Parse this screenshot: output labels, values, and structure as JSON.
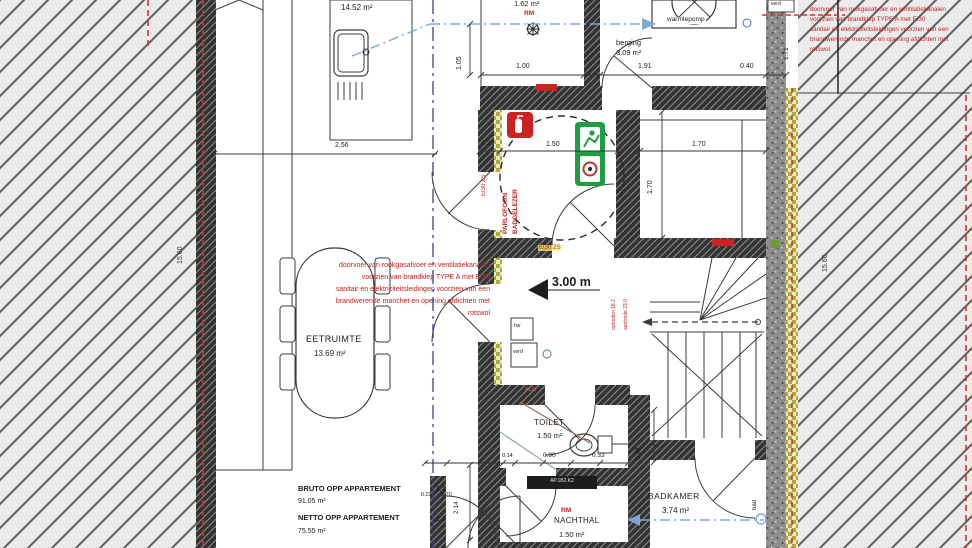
{
  "rooms": {
    "kitchen_area": "14.52 m²",
    "top_small_room_area": "1.62 m²",
    "berging_name": "berging",
    "berging_area": "3.09 m²",
    "eetruimte_name": "EETRUIMTE",
    "eetruimte_area": "13.69 m²",
    "toilet_name": "TOILET",
    "toilet_area": "1.50 m²",
    "nachthal_name": "NACHTHAL",
    "nachthal_area": "1.50 m²",
    "badkamer_name": "BADKAMER",
    "badkamer_area": "3.74 m²"
  },
  "labels": {
    "warmtepomp": "warmtepomp",
    "verd_top": "verd",
    "verd_hall": "verd",
    "hw": "hw",
    "alg": "ALG",
    "bad": "bad",
    "rm_top": "RM",
    "rm_nachthal": "RM",
    "ceiling_height": "3.00 m",
    "ei30_zs_wall": "EI30 ZS",
    "ei30_zs_vertical": "EI30 ZS",
    "intercom_line1": "PARLOFOON",
    "intercom_line2": "BADGELEZER",
    "stair_note_1": "optreden 18.2",
    "stair_note_2": "aantrede 23.0",
    "door_tag": "AP.1B2.K2"
  },
  "summary": {
    "bruto_label": "BRUTO OPP APPARTEMENT",
    "bruto_nr": "1.1",
    "bruto_area": "91.05 m²",
    "netto_label": "NETTO OPP APPARTEMENT",
    "netto_nr": "1.1",
    "netto_area": "75.55 m²"
  },
  "notes": {
    "fire_note": [
      "doorvoer van rookgasafvoer en ventilatiekanalen",
      "voorzien van brandklep TYPE A met EI30",
      "sanitair en elektriciteitsleidingen voorzien van een",
      "brandwerende manchet en opening afdichten met",
      "rotswol"
    ]
  },
  "dimensions": {
    "kitchen_width": "2.56",
    "v105": "1.05",
    "d100": "1.00",
    "d191": "1.91",
    "d040": "0.40",
    "v171": "1.71",
    "d025": "0.25",
    "d150": "1.50",
    "d170h": "1.70",
    "d170v": "1.70",
    "party_left": "15.60",
    "party_right": "15.60",
    "d014": "0.14",
    "d090": "0.90",
    "d033": "0.33",
    "v098": "0.98",
    "v214": "2.14",
    "d022": "0.22",
    "d070": "0.70"
  },
  "colors": {
    "annotation_red": "#c32222",
    "section_blue": "#3a3f8f",
    "vent_blue": "#7fa8d8",
    "exit_green": "#1f9d45",
    "insulation_yellow": "#b0a93f",
    "wall_dark": "#2f2f2f"
  }
}
